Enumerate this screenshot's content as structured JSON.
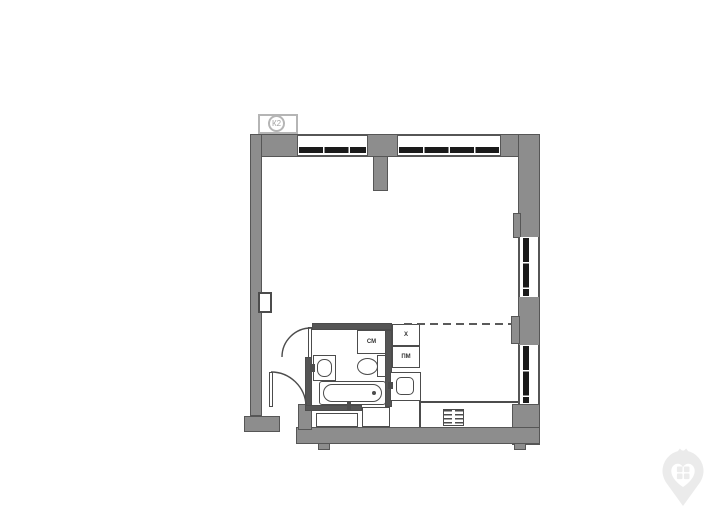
{
  "page": {
    "background": "#ffffff"
  },
  "plan": {
    "riser_label": "К2",
    "labels": {
      "washing_machine": "СМ",
      "dishwasher": "ПМ",
      "fridge": "Х"
    },
    "colors": {
      "page_bg": "#ffffff",
      "wall_fill": "#8d8d8d",
      "wall_edge": "#565656",
      "partition_fill": "#555555",
      "fixture_line": "#4c4c4c",
      "glazing": "#1a1a1a",
      "dashed_line": "#5a5a5a",
      "label_text": "#333333",
      "riser_text": "#a3a3a3",
      "riser_edge": "#b5b5b5",
      "watermark": "#ebebeb"
    },
    "icons": {
      "watermark": "house-pin-logo",
      "bath_door": "door-swing-arc",
      "entry_door": "door-swing-arc"
    }
  }
}
